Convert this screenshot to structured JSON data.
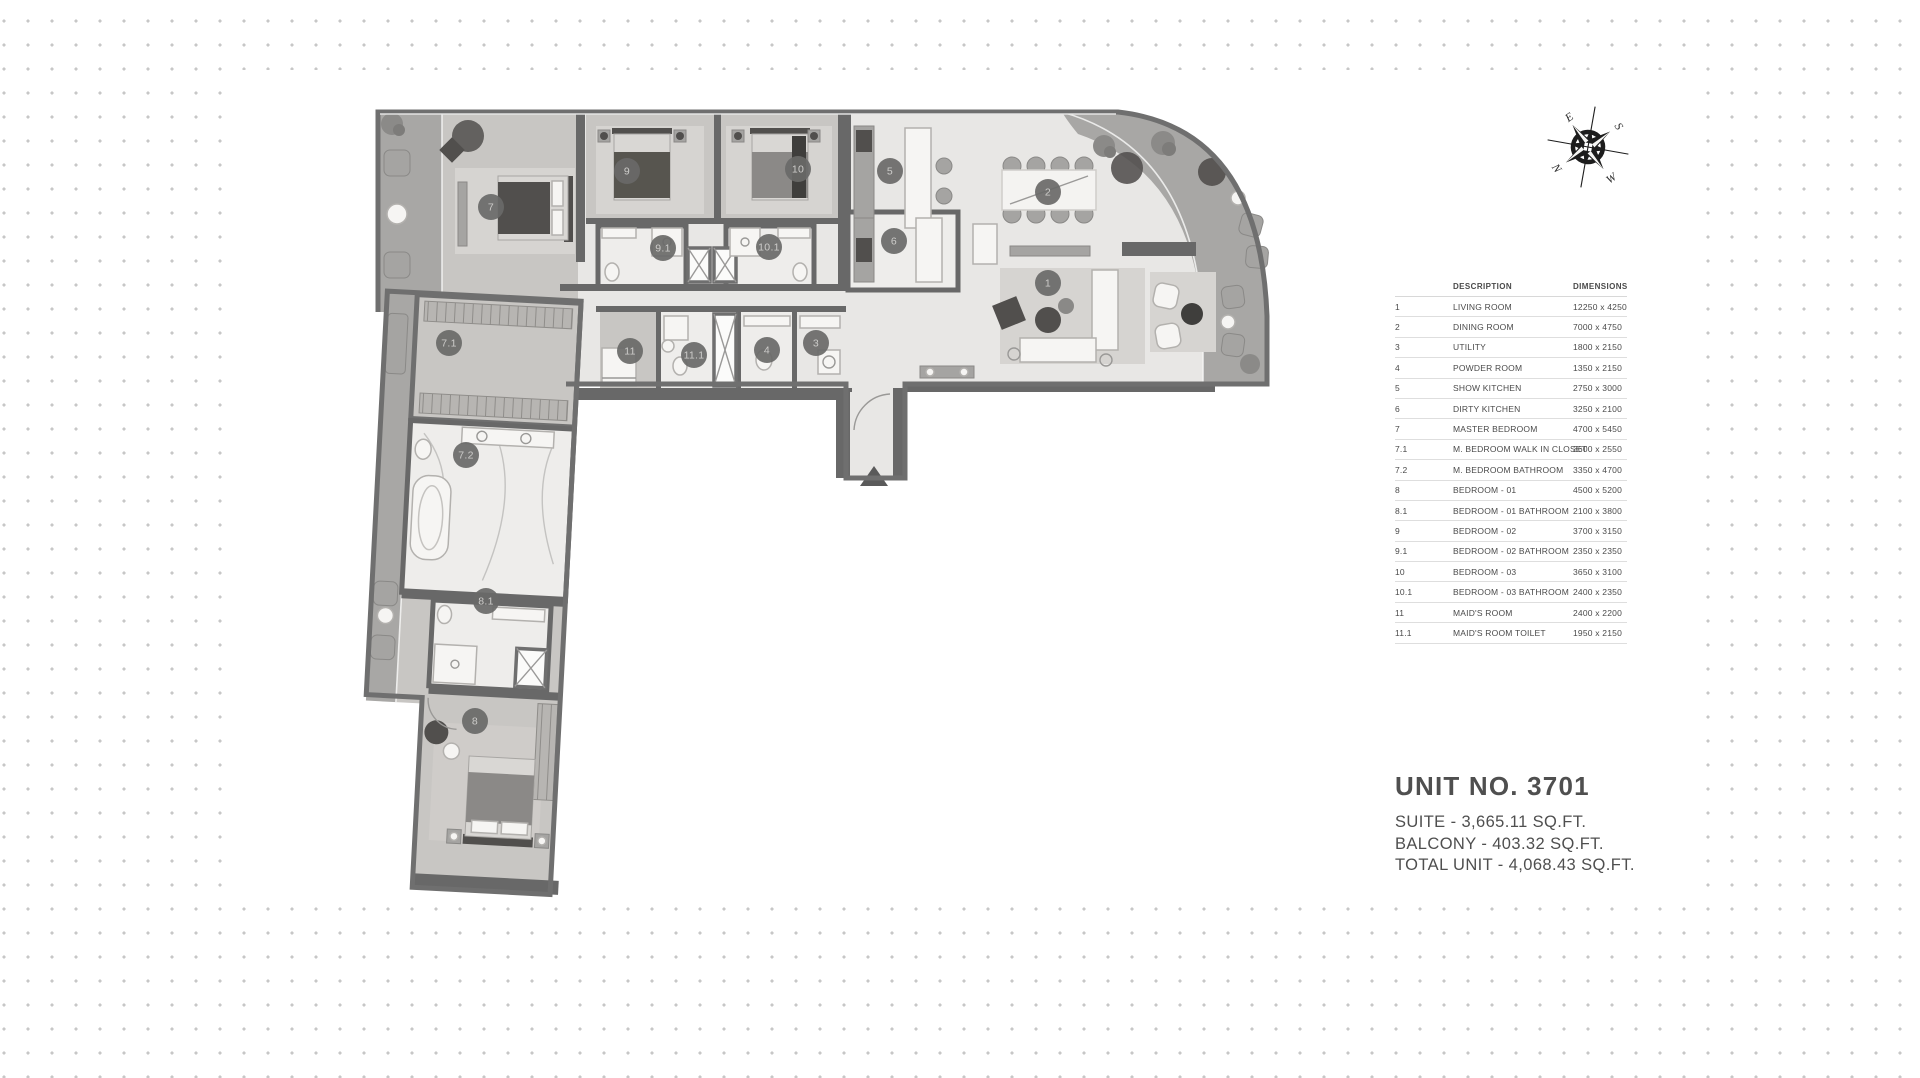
{
  "table": {
    "headers": {
      "description": "DESCRIPTION",
      "dimensions": "DIMENSIONS"
    },
    "rows": [
      {
        "no": "1",
        "desc": "LIVING ROOM",
        "dims": "12250 x 4250"
      },
      {
        "no": "2",
        "desc": "DINING ROOM",
        "dims": "7000 x 4750"
      },
      {
        "no": "3",
        "desc": "UTILITY",
        "dims": "1800 x 2150"
      },
      {
        "no": "4",
        "desc": "POWDER ROOM",
        "dims": "1350 x 2150"
      },
      {
        "no": "5",
        "desc": "SHOW KITCHEN",
        "dims": "2750 x 3000"
      },
      {
        "no": "6",
        "desc": "DIRTY KITCHEN",
        "dims": "3250 x 2100"
      },
      {
        "no": "7",
        "desc": "MASTER BEDROOM",
        "dims": "4700 x 5450"
      },
      {
        "no": "7.1",
        "desc": "M. BEDROOM WALK IN CLOSET",
        "dims": "3600 x 2550"
      },
      {
        "no": "7.2",
        "desc": "M. BEDROOM BATHROOM",
        "dims": "3350 x 4700"
      },
      {
        "no": "8",
        "desc": "BEDROOM - 01",
        "dims": "4500 x 5200"
      },
      {
        "no": "8.1",
        "desc": "BEDROOM -  01 BATHROOM",
        "dims": "2100 x 3800"
      },
      {
        "no": "9",
        "desc": "BEDROOM - 02",
        "dims": "3700 x 3150"
      },
      {
        "no": "9.1",
        "desc": "BEDROOM - 02 BATHROOM",
        "dims": "2350 x 2350"
      },
      {
        "no": "10",
        "desc": "BEDROOM - 03",
        "dims": "3650 x 3100"
      },
      {
        "no": "10.1",
        "desc": "BEDROOM - 03 BATHROOM",
        "dims": "2400 x 2350"
      },
      {
        "no": "11",
        "desc": "MAID'S ROOM",
        "dims": "2400 x 2200"
      },
      {
        "no": "11.1",
        "desc": "MAID'S ROOM TOILET",
        "dims": "1950 x 2150"
      }
    ]
  },
  "unit": {
    "title": "UNIT NO. 3701",
    "lines": [
      "SUITE - 3,665.11 SQ.FT.",
      "BALCONY - 403.32 SQ.FT.",
      "TOTAL UNIT - 4,068.43 SQ.FT."
    ]
  },
  "compass": {
    "north": "N",
    "east": "E",
    "south": "S",
    "west": "W"
  },
  "plan": {
    "markers": [
      {
        "label": "1",
        "x": 1048,
        "y": 283
      },
      {
        "label": "2",
        "x": 1048,
        "y": 192
      },
      {
        "label": "3",
        "x": 816,
        "y": 343
      },
      {
        "label": "4",
        "x": 767,
        "y": 350
      },
      {
        "label": "5",
        "x": 890,
        "y": 171
      },
      {
        "label": "6",
        "x": 894,
        "y": 241
      },
      {
        "label": "7",
        "x": 491,
        "y": 207
      },
      {
        "label": "7.1",
        "x": 449,
        "y": 343
      },
      {
        "label": "7.2",
        "x": 466,
        "y": 455
      },
      {
        "label": "8",
        "x": 475,
        "y": 721
      },
      {
        "label": "8.1",
        "x": 486,
        "y": 601
      },
      {
        "label": "9",
        "x": 627,
        "y": 171
      },
      {
        "label": "9.1",
        "x": 663,
        "y": 248
      },
      {
        "label": "10",
        "x": 798,
        "y": 169
      },
      {
        "label": "10.1",
        "x": 769,
        "y": 247
      },
      {
        "label": "11",
        "x": 630,
        "y": 351
      },
      {
        "label": "11.1",
        "x": 694,
        "y": 355
      }
    ]
  }
}
